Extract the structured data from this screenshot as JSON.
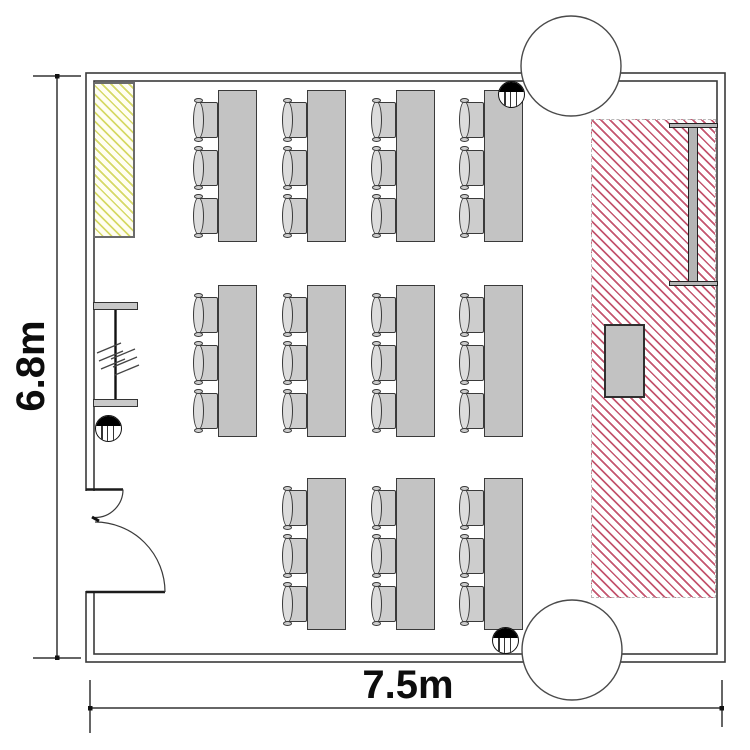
{
  "plan_title": "classroom floor plan",
  "labels": {
    "room_height": "6.8m",
    "room_width": "7.5m"
  },
  "colors": {
    "line": "#3a3a3a",
    "table_fill": "#c3c3c3",
    "chair_fill": "#cdcdcd",
    "backrest_fill": "#dcdcdc",
    "lectern_fill": "#c2c2c2",
    "screen_fill": "#b5b5b5",
    "partition_fill": "#c9c9c9",
    "red_hatch": "#c4566f",
    "yellow_hatch": "#d6d966"
  },
  "furniture": {
    "desk_group_count": 11,
    "chairs_per_table": 3,
    "desk_groups": [
      {
        "x": 192,
        "y": 90
      },
      {
        "x": 281,
        "y": 90
      },
      {
        "x": 370,
        "y": 90
      },
      {
        "x": 458,
        "y": 90
      },
      {
        "x": 192,
        "y": 285
      },
      {
        "x": 281,
        "y": 285
      },
      {
        "x": 370,
        "y": 285
      },
      {
        "x": 458,
        "y": 285
      },
      {
        "x": 281,
        "y": 478
      },
      {
        "x": 370,
        "y": 478
      },
      {
        "x": 458,
        "y": 478
      }
    ],
    "chair_y_offsets": [
      9,
      57,
      105
    ]
  },
  "fixtures": {
    "round_columns": [
      {
        "cx": 571,
        "cy": 66,
        "r": 50
      },
      {
        "cx": 572,
        "cy": 650,
        "r": 50
      }
    ],
    "floor_symbols": [
      {
        "cx": 511,
        "cy": 94
      },
      {
        "cx": 108,
        "cy": 428
      },
      {
        "cx": 505,
        "cy": 640
      }
    ]
  }
}
